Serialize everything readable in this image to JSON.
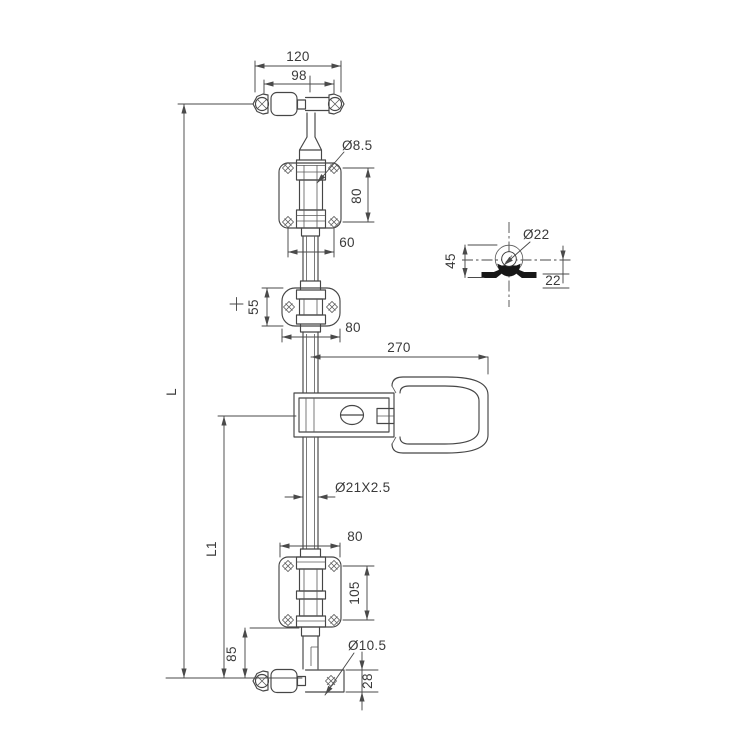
{
  "drawing": {
    "background_color": "#ffffff",
    "line_color": "#464646",
    "dim_color": "#4a4a4a",
    "section_fill_color": "#171717",
    "labels": {
      "dim_cam_width_outer": "120",
      "dim_cam_width_inner": "98",
      "dia_upper_hole": "Ø8.5",
      "dim_upper_bracket_height": "80",
      "dim_upper_bracket_width": "60",
      "dim_mid_guide_height": "55",
      "plus_mark": "+",
      "dim_mid_guide_width": "80",
      "dim_handle_length": "270",
      "dia_keeper_hole": "Ø22",
      "dim_keeper_height": "45",
      "dim_keeper_offset": "22",
      "dia_tube": "Ø21X2.5",
      "dim_lower_bracket_width": "80",
      "dim_lower_bracket_height": "105",
      "dim_bottom_offset": "85",
      "dia_bottom_hole": "Ø10.5",
      "dim_bottom_cam_height": "28",
      "label_overall_length": "L",
      "label_lower_length": "L1"
    }
  }
}
